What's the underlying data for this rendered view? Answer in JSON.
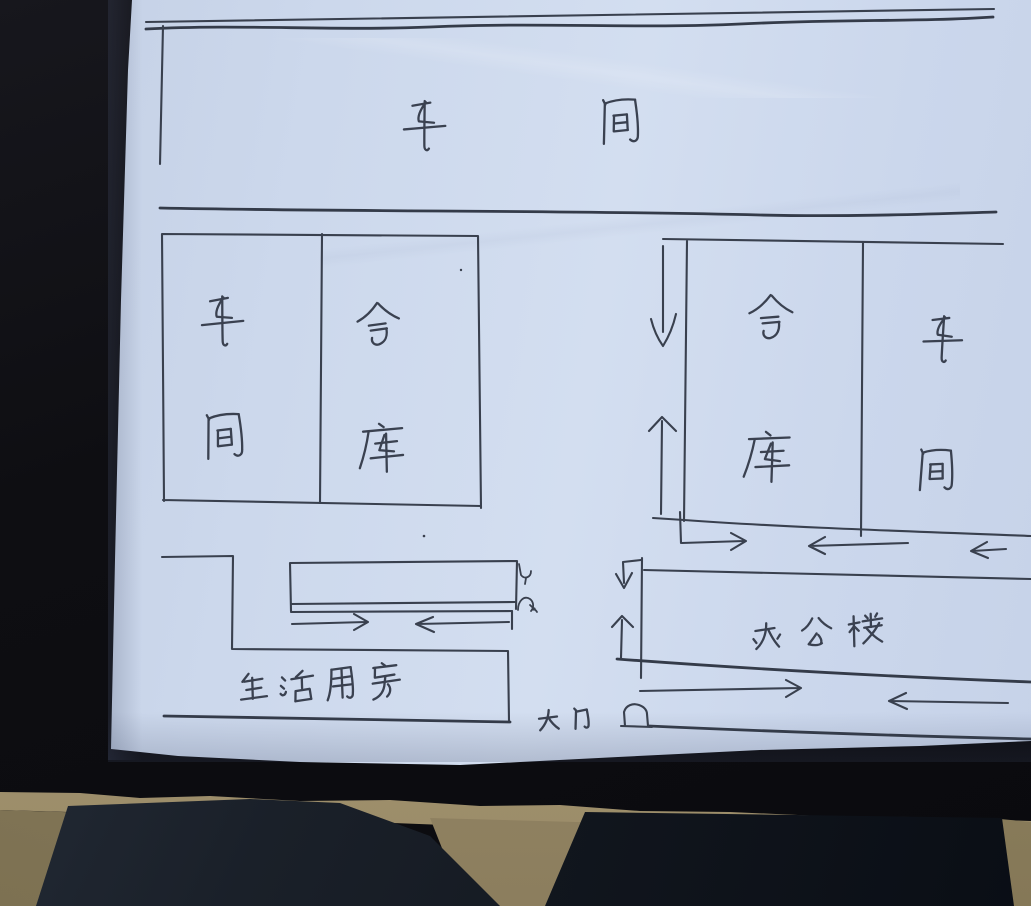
{
  "labels": {
    "title_workshop": "车间",
    "left_block_workshop": "车间",
    "left_block_warehouse": "仓库",
    "right_block_warehouse": "仓库",
    "right_block_workshop": "车间",
    "office_building": "办公楼",
    "living_quarters": "生活用房",
    "main_gate": "大门"
  },
  "symbols": {
    "gate_icon": "small-gate-box",
    "flow_arrows": [
      "down",
      "up",
      "right",
      "left",
      "left",
      "hook-down",
      "up",
      "right",
      "left",
      "right",
      "left"
    ]
  },
  "colors": {
    "paper": "#cdd8ec",
    "ink": "#3b4250",
    "background": "#0e0e12",
    "floor": "#a4956f",
    "denim": "#1a212c"
  }
}
